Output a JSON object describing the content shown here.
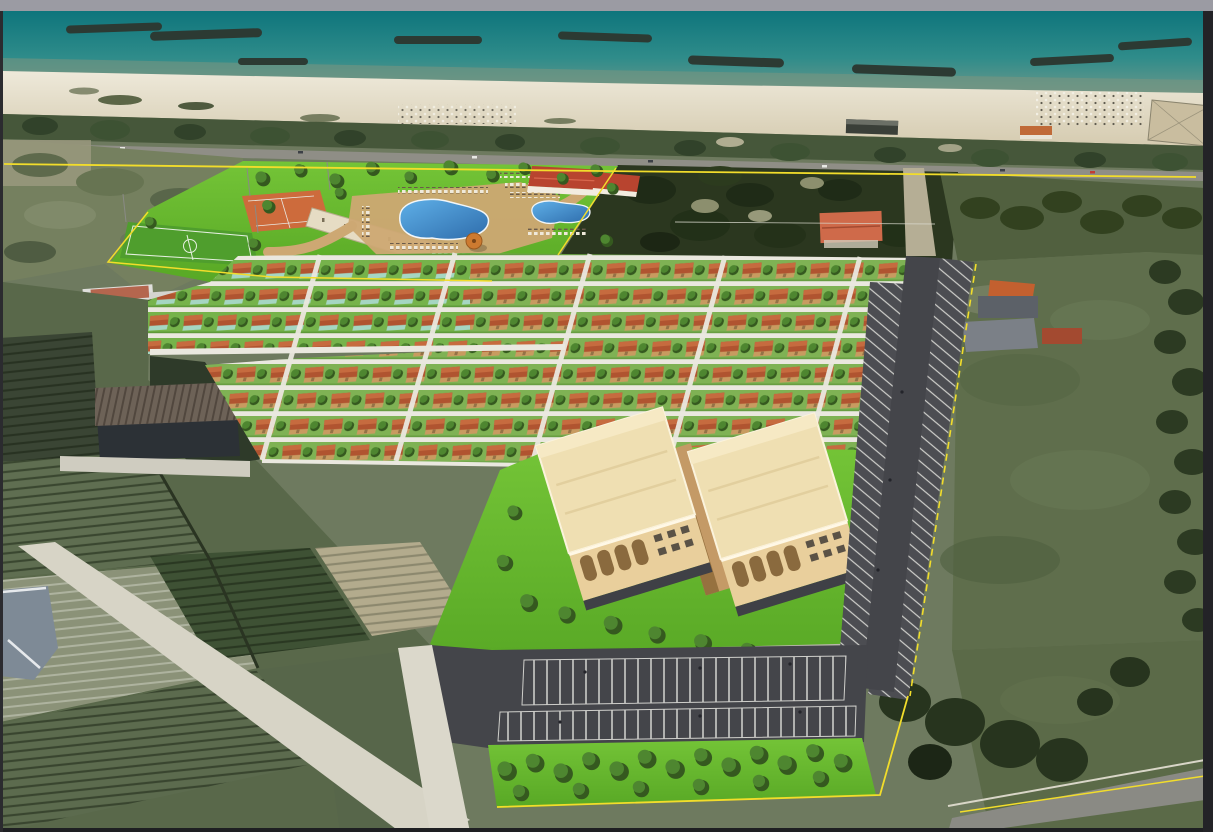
{
  "image": {
    "kind": "aerial-photomontage-render",
    "description": "Bird's-eye rendering of a seaside tourist village masterplan composited over satellite photo: beach with breakwaters, coastal road, sports courts, two free-form pools with clubhouse, grid of terracotta-roof bungalows, two cream apartment blocks, asphalt parking lots, yellow site boundary, surrounded by farmland and green fields."
  },
  "scene": {
    "areas": {
      "sea": "teal sea with dark breakwater jetties",
      "beach": "white sandy beach with umbrella clusters and beach bars",
      "coast_road": "coastal road lined with trees",
      "sports_zone": "orange multi-court and five-a-side pitch with service building",
      "pool_zone": "two free-form blue pools, sun loungers, red-roof clubhouse, gazebo",
      "bungalow_zone": "grid of terracotta-roofed bungalows with trees and white paths",
      "apartment_zone": "two cream three-storey apartment blocks with loggias",
      "parking": "asphalt lots and road with white-striped bays",
      "tree_strip": "double row of trees along the south parking edge",
      "boundary": "yellow property boundary line",
      "west_farmland": "existing crop fields, barn and white houses",
      "east_field": "large green field with farmhouse and barns"
    }
  },
  "colors": {
    "frame_top": "#9b9ba3",
    "frame_edge": "#232327",
    "sea_deep": "#0e757c",
    "sea_mid": "#2f8c8a",
    "sea_shallow": "#6f988a",
    "sand_light": "#eee9da",
    "sand_dark": "#d5cbb0",
    "breakwater": "#2c3a33",
    "veg_band": "#46573a",
    "tree_dark": "#35591f",
    "tree_green": "#4e8630",
    "road": "#8f8e86",
    "boundary_yellow": "#f2dd2b",
    "scrub": "#75805f",
    "lawn_light": "#74c437",
    "lawn_dark": "#58a825",
    "lawnA": "#76b34b",
    "lawnB": "#7fb254",
    "court_orange": "#cd6b3c",
    "pitch_green": "#4f9e2d",
    "sports_building": "#e6dcc4",
    "deck_tan": "#cda873",
    "pool_light": "#5fb0e8",
    "pool_deep": "#2e6cab",
    "clubhouse_roof": "#b8442f",
    "clubhouse_wall": "#f2ece0",
    "gazebo_orange": "#cd7a30",
    "bungalow_roof": "#b05430",
    "bungalow_roof_light": "#c66b3f",
    "wall_teal": "#a5d6c2",
    "wall_tan": "#c89b60",
    "path_white": "#eae8df",
    "apt_roof": "#efdfb2",
    "apt_roof_edge": "#fbf3dc",
    "apt_wall": "#e9cf9c",
    "apt_arch": "#8a6a3e",
    "apt_garage": "#3f4046",
    "courtyard_tan": "#c49a66",
    "asphalt": "#44454a",
    "asphalt_bay": "#4c4d52",
    "stripe_white": "#d5d5d1",
    "field_right": "#5f6e4c",
    "field_dark": "#3e5134",
    "field_green": "#5c6b4e",
    "field_pale": "#8b9278",
    "field_tan": "#b3ab8d",
    "path_field": "#d7d4c6",
    "barn_dark": "#2c3136",
    "barn_roof": "#6d6257",
    "house_white": "#e7e7e3",
    "house_red_roof": "#b4664e",
    "villa_roof": "#cf6a4a",
    "dark_block": "#2b371f",
    "farm_roof_orange": "#c3602f",
    "farm_roof_gray": "#7b8087",
    "shed_red": "#a34a30",
    "field_br": "#5b6a48",
    "road_br": "#8a8a84",
    "blue_building": "#7e8a96"
  }
}
